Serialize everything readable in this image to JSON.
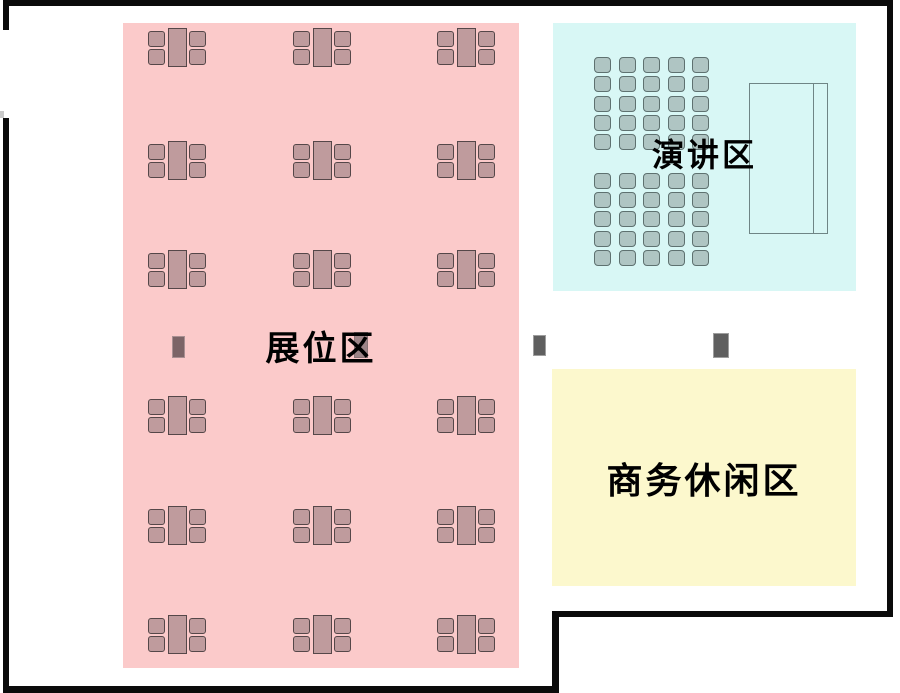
{
  "plan": {
    "name": "会场平面图",
    "background": "#ffffff",
    "wall_color": "#0b0b0b"
  },
  "areas": {
    "booth": {
      "label": "展位区",
      "bg": "#FBCACA",
      "x": 123,
      "y": 23,
      "w": 396,
      "h": 645
    },
    "speech": {
      "label": "演讲区",
      "bg": "#D8F7F5",
      "x": 553,
      "y": 23,
      "w": 303,
      "h": 268
    },
    "lounge": {
      "label": "商务休闲区",
      "bg": "#FCF8CD",
      "x": 552,
      "y": 369,
      "w": 304,
      "h": 217
    }
  },
  "walls": [
    {
      "name": "wall-top",
      "x": 3,
      "y": 0,
      "w": 890,
      "h": 6
    },
    {
      "name": "wall-right",
      "x": 887,
      "y": 0,
      "w": 6,
      "h": 617
    },
    {
      "name": "wall-notch-horizontal",
      "x": 552,
      "y": 611,
      "w": 341,
      "h": 6
    },
    {
      "name": "wall-notch-vertical",
      "x": 552,
      "y": 611,
      "w": 7,
      "h": 82
    },
    {
      "name": "wall-bottom",
      "x": 3,
      "y": 686,
      "w": 556,
      "h": 7
    },
    {
      "name": "wall-left-upper",
      "x": 3,
      "y": 0,
      "w": 6,
      "h": 30
    },
    {
      "name": "wall-left-lower",
      "x": 3,
      "y": 118,
      "w": 6,
      "h": 575
    },
    {
      "name": "door-jamb-mark",
      "x": 0,
      "y": 111,
      "w": 4,
      "h": 7,
      "color": "#c9c9c9"
    }
  ],
  "booth_tables": {
    "col_x": [
      148,
      293,
      437
    ],
    "row_y": [
      28,
      141,
      250,
      396,
      506,
      615
    ],
    "cluster_w": 58,
    "cluster_h": 39,
    "table": {
      "x": 20,
      "y": 0,
      "w": 19,
      "h": 39
    },
    "chair_offsets": [
      [
        0,
        3
      ],
      [
        0,
        21
      ],
      [
        41,
        3
      ],
      [
        41,
        21
      ]
    ],
    "chair_w": 17,
    "chair_h": 16,
    "fill": "#BF9B9D",
    "stroke": "#554749"
  },
  "speech_seats": {
    "col_x": [
      594,
      619,
      643,
      668,
      692
    ],
    "row_y_top_block": [
      57,
      76,
      96,
      115,
      134
    ],
    "row_y_bottom_block": [
      173,
      192,
      211,
      231,
      250
    ],
    "seat_w": 17,
    "seat_h": 16,
    "fill": "#AFC5C3",
    "stroke": "#5e7170"
  },
  "stage": {
    "x": 749,
    "y": 83,
    "w": 79,
    "h": 151,
    "inner_line_offset": 63,
    "stroke": "#6F8585"
  },
  "pillars": [
    {
      "name": "pillar-1",
      "x": 172,
      "y": 336,
      "w": 13,
      "h": 22,
      "fill": "#7C6467",
      "stroke": "#A98F92"
    },
    {
      "name": "pillar-2",
      "x": 354,
      "y": 332,
      "w": 14,
      "h": 26,
      "fill": "#9C8487",
      "stroke": "#8A7376"
    },
    {
      "name": "pillar-3",
      "x": 533,
      "y": 335,
      "w": 13,
      "h": 21,
      "fill": "#5F5F5F",
      "stroke": "#9E9E9E"
    },
    {
      "name": "pillar-4",
      "x": 713,
      "y": 333,
      "w": 16,
      "h": 25,
      "fill": "#5F5F5F",
      "stroke": "#9E9E9E"
    }
  ]
}
